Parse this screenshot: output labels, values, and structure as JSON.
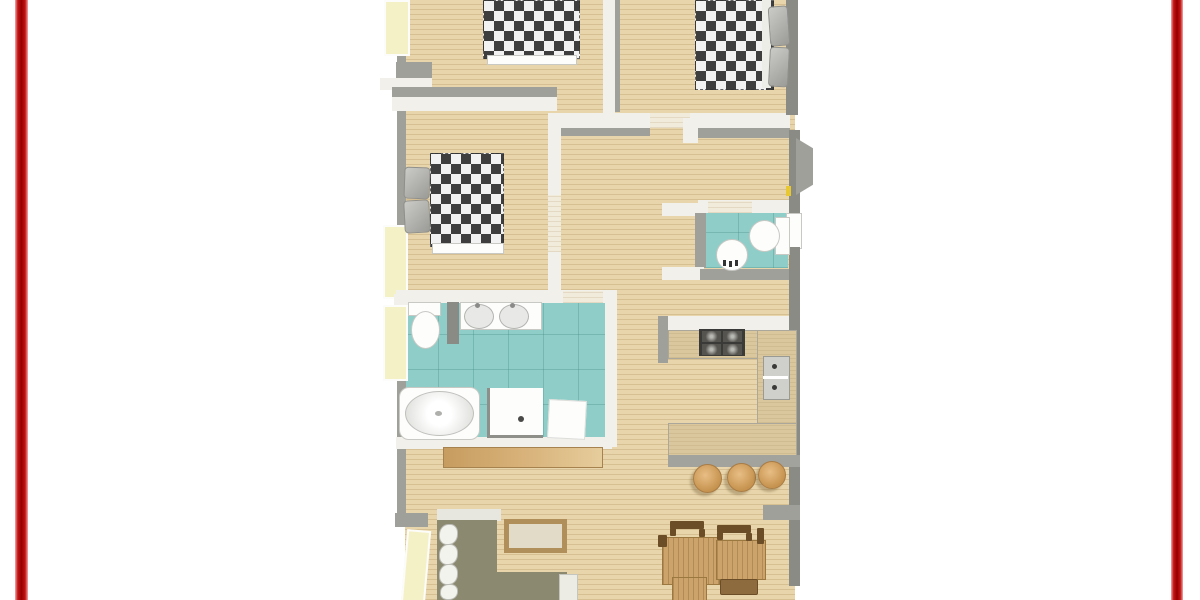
{
  "image": {
    "kind": "top-down 3D rendered apartment floor plan, framed by two vertical red border bars on a white page; plan is cropped at top and bottom edges"
  },
  "palette": {
    "background": "#FEFFFE",
    "red_bar": "#B30505",
    "wood_floor": "#E8D5AB",
    "tile_teal": "#8FCEC8",
    "teal_grout": "rgba(70,140,135,0.35)",
    "wall_white": "#F1F0EB",
    "wall_gray": "#A0A09A",
    "wall_gray_dark": "#8B8B86",
    "window_cream": "#F5F1C6",
    "threshold_light": "#F1EBDB",
    "checker_dark": "#3E3E3E",
    "checker_light": "#F2F2F2",
    "fixture_white": "#FDFDFC",
    "basin_gray": "#E8E8E6",
    "counter_tan": "#DAC79D",
    "counter_edge": "#ABA79B",
    "stove_dark": "#3A3A38",
    "sofa_olive": "#8B8A71",
    "sofa_cushion_white": "#F3F3EE",
    "pillow_gray": "#9A9A96",
    "table_wood": "#CCA36B",
    "chair_dark": "#6B4E28",
    "chair_seat": "#8D6B3F",
    "stool_wood": "#C6934F",
    "sideboard_wood": "#D9B47C",
    "handle_yellow": "#E8C832"
  },
  "inventory": {
    "rooms": [
      "bedroom-top-left",
      "bedroom-top-right",
      "bedroom-middle-left",
      "main-bathroom",
      "powder-room",
      "kitchen",
      "hallway",
      "living-dining-area"
    ],
    "furniture": [
      "checkered-double-bed x3",
      "gray-pillows",
      "toilet x2",
      "double-vanity-sinks",
      "round-sink",
      "bathtub",
      "shower-stall",
      "bath-mat",
      "gas-cooktop",
      "double-kitchen-sink",
      "u-shaped-counter",
      "kitchen-island",
      "bar-stool x3",
      "sideboard",
      "l-shaped-sofa",
      "coffee-table",
      "dining-table",
      "dining-chair x4"
    ],
    "openings": [
      "left-windows x4",
      "right-entry-door",
      "powder-room-window",
      "interior-door-thresholds"
    ]
  }
}
